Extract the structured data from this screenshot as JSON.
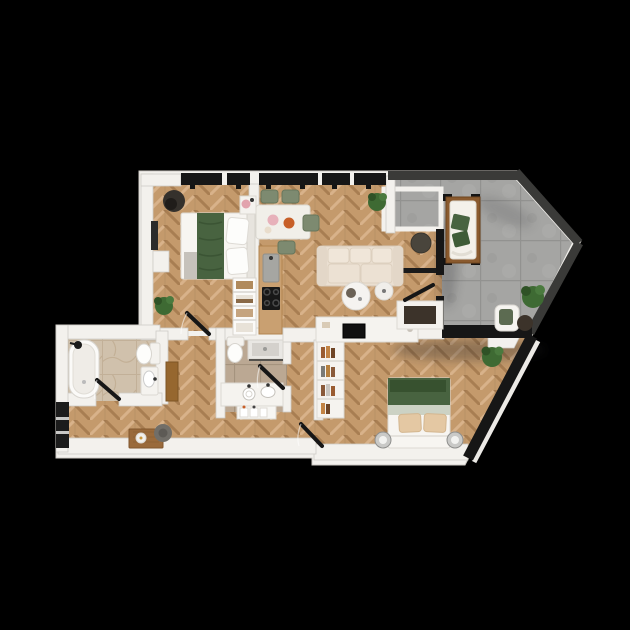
{
  "canvas": {
    "width": 630,
    "height": 630,
    "background": "#000000"
  },
  "palette": {
    "wall": "#f3f1ed",
    "wall_shadow": "#cfccc6",
    "wood_base": "#c49a6c",
    "wood_light": "#d8b28a",
    "wood_dark": "#a87e52",
    "concrete": "#a5a5a3",
    "concrete_line": "#929290",
    "parapet": "#3a3a38",
    "window": "#161616",
    "bath1_tile": "#d0c1ac",
    "bath2_tile": "#bba893",
    "marble": "#f1efe9",
    "bed_green": "#486340",
    "bed_green_dark": "#37512f",
    "pillow_beige": "#e4c8a3",
    "sofa": "#eadfd1",
    "sofa_cushion": "#f0e6d9",
    "chair_green": "#7d8a70",
    "plant": "#3e6a33",
    "plant_dark": "#2f5226",
    "dark_table": "#49453c",
    "pouf_dark": "#35312c",
    "gray_pouf": "#716e68",
    "counter_wood": "#c9a071",
    "daybed_wood": "#8a5a2e",
    "bench_wood": "#9a6a3b",
    "steel": "#c9c9c7",
    "tv_black": "#111111",
    "pink": "#e2a3ad",
    "orange": "#c75f28",
    "white": "#fbfaf8"
  },
  "rooms": [
    {
      "id": "bedroom-1",
      "furniture": [
        "double-bed-green-throw",
        "dark-round-pouf",
        "potted-plant",
        "coffee-machine-stand",
        "radiator",
        "interior-door"
      ]
    },
    {
      "id": "kitchen-dining",
      "furniture": [
        "marble-dining-table",
        "dining-chair",
        "dining-chair",
        "dining-chair",
        "dining-chair",
        "wooden-kitchen-counter",
        "kitchen-sink",
        "induction-cooktop",
        "tall-cabinet-column",
        "open-wardrobe"
      ]
    },
    {
      "id": "living-room",
      "furniture": [
        "cream-sofa",
        "round-coffee-table-large",
        "round-coffee-table-small",
        "dark-side-table",
        "potted-plant",
        "tv-console",
        "tv",
        "storage-bench"
      ]
    },
    {
      "id": "terrace",
      "furniture": [
        "wooden-daybed",
        "green-cushions",
        "lounge-chair",
        "dark-side-table",
        "potted-plant",
        "planter-box"
      ]
    },
    {
      "id": "bathroom-1",
      "furniture": [
        "bathtub",
        "shower-head",
        "toilet",
        "washbasin-cabinet",
        "interior-door"
      ]
    },
    {
      "id": "bathroom-2",
      "furniture": [
        "toilet",
        "walk-in-shower",
        "double-washbasin-vanity",
        "toiletry-shelf",
        "interior-door"
      ]
    },
    {
      "id": "bedroom-2",
      "furniture": [
        "double-bed-green-blanket",
        "bedside-table",
        "bedside-table",
        "bookshelf",
        "potted-plant"
      ]
    },
    {
      "id": "hallway",
      "furniture": [
        "wooden-bench",
        "round-pouf",
        "wooden-cabinet",
        "balcony-door",
        "bedroom-door"
      ]
    }
  ]
}
